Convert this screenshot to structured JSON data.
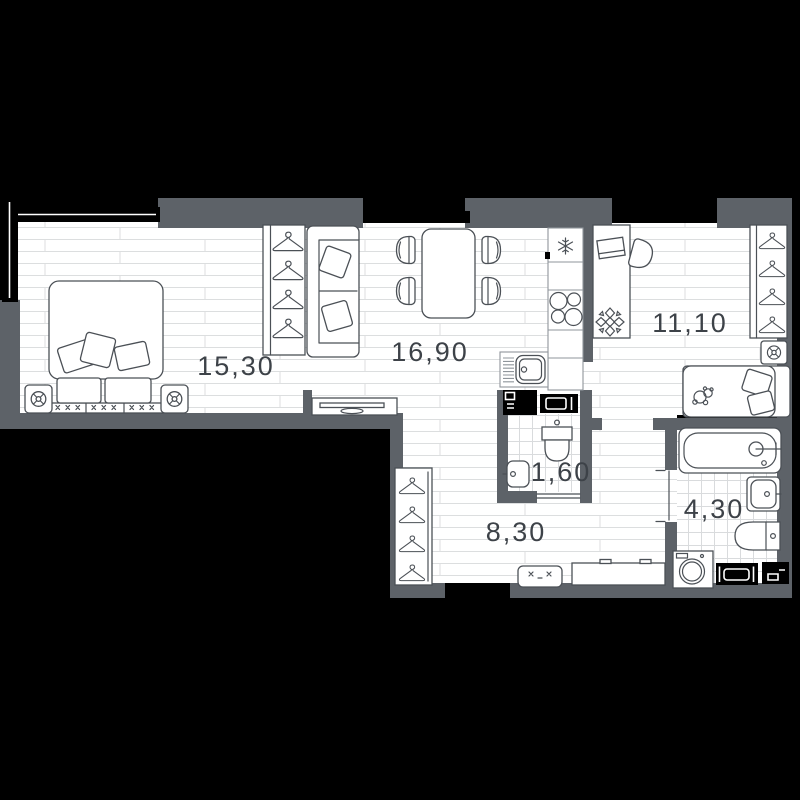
{
  "plan": {
    "colors": {
      "background": "#000000",
      "wall": "#5d6268",
      "floor": "#ffffff",
      "floor_line": "#dcdedf",
      "furniture_outline": "#4b5056",
      "label_text": "#3d4248"
    },
    "rooms": [
      {
        "name": "bedroom",
        "area_label": "15,30"
      },
      {
        "name": "living-kitchen",
        "area_label": "16,90"
      },
      {
        "name": "bedroom-2",
        "area_label": "11,10"
      },
      {
        "name": "wc",
        "area_label": "1,60"
      },
      {
        "name": "hallway",
        "area_label": "8,30"
      },
      {
        "name": "bathroom",
        "area_label": "4,30"
      }
    ]
  }
}
